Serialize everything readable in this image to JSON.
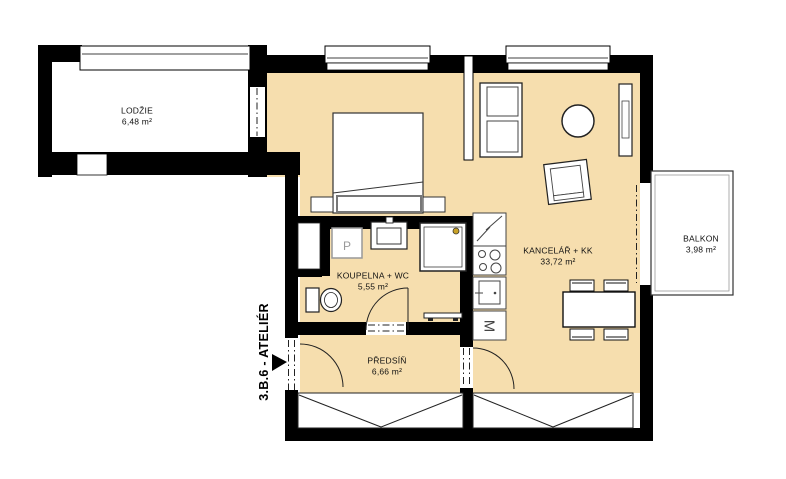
{
  "unit": {
    "label": "3.B.6 - ATELIÉR"
  },
  "rooms": {
    "lodzie": {
      "name": "LODŽIE",
      "area": "6,48 m²"
    },
    "kancelar": {
      "name": "KANCELÁŘ + KK",
      "area": "33,72 m²"
    },
    "koupelna": {
      "name": "KOUPELNA + WC",
      "area": "5,55 m²"
    },
    "predsin": {
      "name": "PŘEDSÍŇ",
      "area": "6,66 m²"
    },
    "balkon": {
      "name": "BALKON",
      "area": "3,98 m²"
    }
  },
  "appliances": {
    "washing_machine": "P",
    "dishwasher": "M"
  },
  "colors": {
    "floor": "#f6deae",
    "wall": "#000000",
    "outline": "#222222",
    "background": "#ffffff",
    "accent_dot": "#c9a227"
  }
}
